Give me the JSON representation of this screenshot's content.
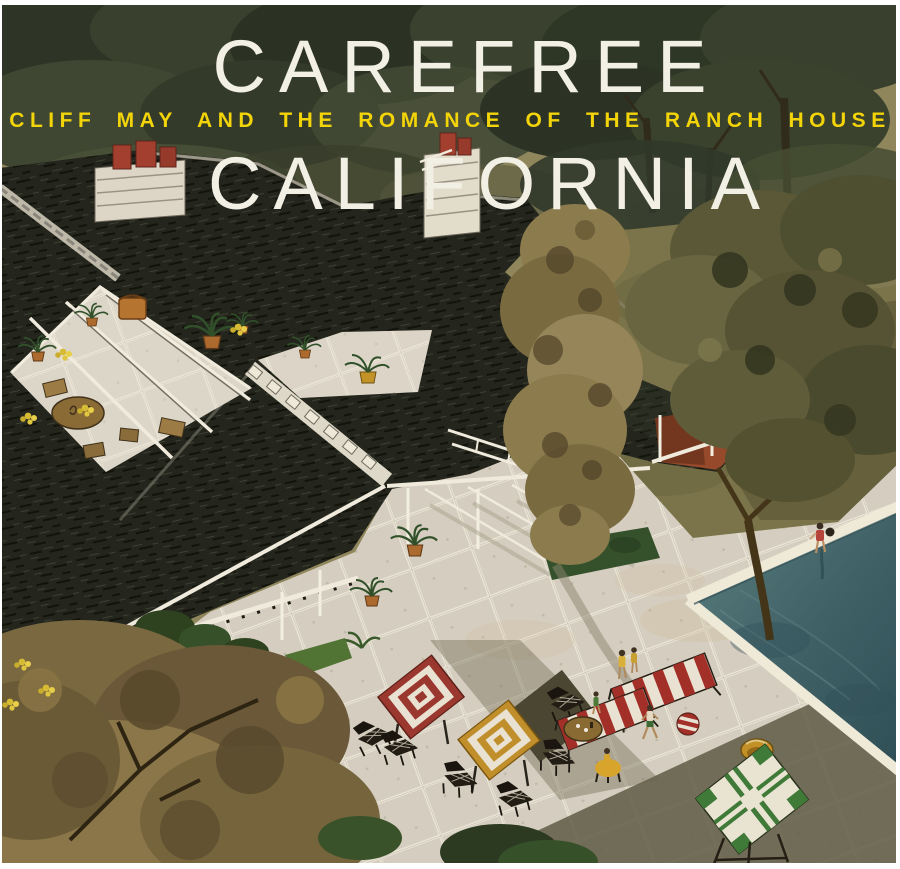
{
  "cover": {
    "title_line1": "CAREFREE",
    "subtitle": "CLIFF MAY AND THE ROMANCE OF THE RANCH HOUSE",
    "title_line2": "CALIFORNIA"
  },
  "palette": {
    "title_text": "#f2efe5",
    "subtitle_text": "#f2d408",
    "roof": "#24261e",
    "ridge_skylight": "#ded8c8",
    "paving": "#d5cec0",
    "grout": "#eae4d6",
    "lawn": "#7b744a",
    "pool_water": "#476a6e",
    "pool_coping": "#efe9d8",
    "grove_green": "#39402e",
    "tree_olive": "#8c7b4d",
    "quilt_red": "#9a382f",
    "quilt_gold": "#c08f2b",
    "table_green": "#3f7a38",
    "lounger_red": "#a23028",
    "brick_porch": "#96492b",
    "chimney_stone": "#ddd6c6",
    "chimney_pot_red": "#a33f2f",
    "shadow_olive": "#5a573f",
    "border": "#ffffff"
  },
  "illustration": {
    "style": "watercolor aerial view of a ranch house",
    "elements": [
      "oak-grove-background",
      "shake-shingle-roofs",
      "ridge-skylights",
      "stone-chimney-with-clay-pots",
      "courtyard-patio",
      "pergola-beams",
      "potted-palms",
      "garden-furniture",
      "covered-walkway",
      "central-poplar-tree",
      "large-oak-tree",
      "lawn",
      "flagstone-pool-deck",
      "swimming-pool",
      "swimmer-at-pool-edge",
      "red-white-quilt-table",
      "gold-white-quilt-table",
      "green-tile-table",
      "striped-sun-loungers",
      "figures-in-swimwear",
      "beach-ball",
      "yellow-bowl",
      "long-tree-shadow"
    ]
  }
}
